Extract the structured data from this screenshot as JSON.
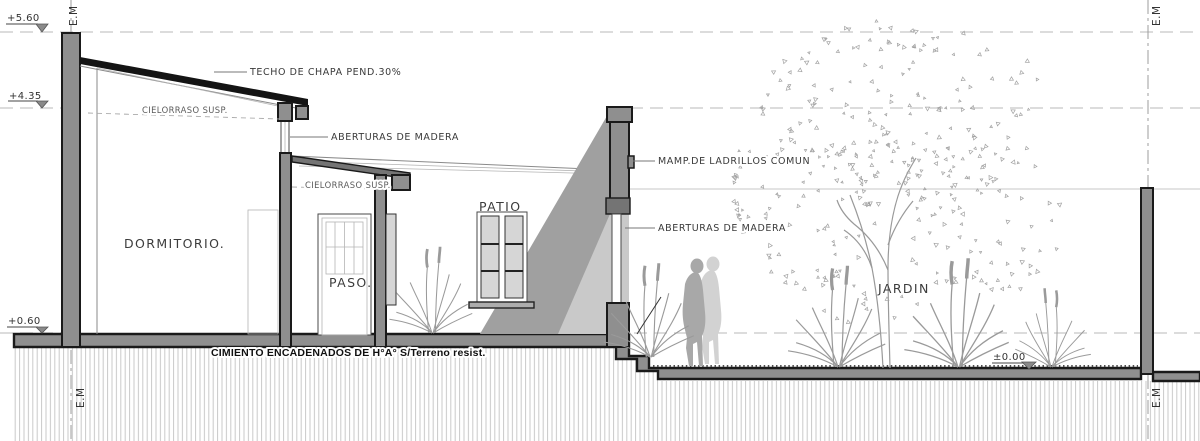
{
  "drawing_title": "house longitudinal section",
  "levels": {
    "l560": "+5.60",
    "l435": "+4.35",
    "l060": "+0.60",
    "l000": "±0.00"
  },
  "axes": {
    "em": "E.M"
  },
  "rooms": {
    "dormitorio": "DORMITORIO.",
    "paso": "PASO.",
    "patio": "PATIO",
    "jardin": "JARDIN"
  },
  "annotations": {
    "roof": "TECHO DE CHAPA PEND.30%",
    "ceiling1": "CIELORRASO SUSP.",
    "ceiling2": "CIELORRASO SUSP.",
    "openings1": "ABERTURAS DE MADERA",
    "openings2": "ABERTURAS DE MADERA",
    "masonry": "MAMP.DE LADRILLOS COMUN",
    "foundation": "CIMIENTO ENCADENADOS DE H°A°  S/Terreno resist."
  },
  "colors": {
    "wall_fill": "#8f8f8f",
    "beam_fill": "#747474",
    "outline": "#1a1a1a",
    "shadow_dark": "#a0a0a0",
    "shadow_light": "#c9c9c9",
    "glass": "#d6d6d6",
    "figure": "#a8a8a8"
  }
}
